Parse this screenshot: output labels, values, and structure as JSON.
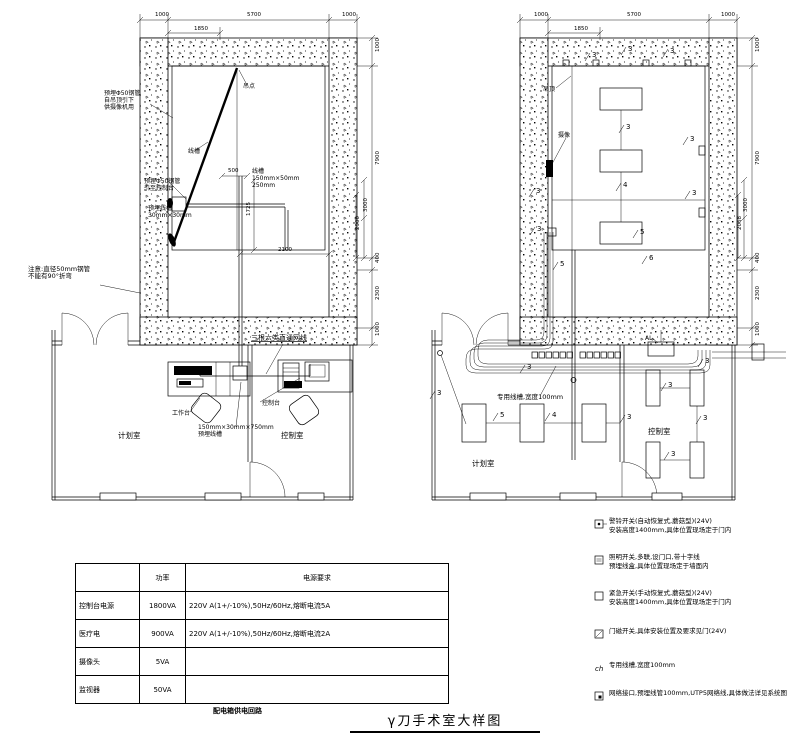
{
  "title": "γ刀手术室大样图",
  "table": {
    "caption": "配电箱供电回路",
    "headers": [
      "",
      "功率",
      "电源要求"
    ],
    "rows": [
      [
        "控制台电源",
        "1800VA",
        "220V A(1+/-10%),50Hz/60Hz,熔断电流5A"
      ],
      [
        "医疗电",
        "900VA",
        "220V A(1+/-10%),50Hz/60Hz,熔断电流2A"
      ],
      [
        "摄像头",
        "5VA",
        ""
      ],
      [
        "监视器",
        "50VA",
        ""
      ]
    ]
  },
  "legend": {
    "items": [
      {
        "name": "bell-switch",
        "lines": [
          "警铃开关(自动恢复式,蘑菇型)(24V)",
          "安装高度1400mm,具体位置现场定于门内"
        ]
      },
      {
        "name": "lighting-switch",
        "lines": [
          "照明开关,多联,设门口,带十字线",
          "预埋线盒,具体位置现场定于墙面内"
        ]
      },
      {
        "name": "emergency-switch",
        "lines": [
          "紧急开关(手动恢复式,蘑菇型)(24V)",
          "安装高度1400mm,具体位置现场定于门内"
        ]
      },
      {
        "name": "door-magnetic-switch",
        "lines": [
          "门磁开关,具体安装位置及要求见门(24V)"
        ]
      },
      {
        "name": "cable-tray",
        "symbol_text": "ch",
        "lines": [
          "专用线槽,宽度100mm"
        ]
      },
      {
        "name": "network-outlet",
        "lines": [
          "网络接口,预埋线管100mm,UTP5网络线,具体做法详见系统图"
        ]
      }
    ]
  },
  "annotations": {
    "dims": [
      {
        "t": "1000",
        "x": 155,
        "y": 16
      },
      {
        "t": "5700",
        "x": 247,
        "y": 16
      },
      {
        "t": "1000",
        "x": 342,
        "y": 16
      },
      {
        "t": "1850",
        "x": 194,
        "y": 30
      },
      {
        "t": "1000",
        "x": 534,
        "y": 16
      },
      {
        "t": "5700",
        "x": 627,
        "y": 16
      },
      {
        "t": "1000",
        "x": 721,
        "y": 16
      },
      {
        "t": "1850",
        "x": 574,
        "y": 30
      },
      {
        "t": "1000",
        "x": 379,
        "y": 52,
        "rot": true
      },
      {
        "t": "7900",
        "x": 379,
        "y": 165,
        "rot": true
      },
      {
        "t": "3000",
        "x": 367,
        "y": 212,
        "rot": true
      },
      {
        "t": "2900",
        "x": 359,
        "y": 230,
        "rot": true
      },
      {
        "t": "400",
        "x": 379,
        "y": 263,
        "rot": true
      },
      {
        "t": "2300",
        "x": 379,
        "y": 300,
        "rot": true
      },
      {
        "t": "1000",
        "x": 379,
        "y": 336,
        "rot": true
      },
      {
        "t": "1000",
        "x": 759,
        "y": 52,
        "rot": true
      },
      {
        "t": "7900",
        "x": 759,
        "y": 165,
        "rot": true
      },
      {
        "t": "3000",
        "x": 747,
        "y": 212,
        "rot": true
      },
      {
        "t": "2068",
        "x": 741,
        "y": 230,
        "rot": true
      },
      {
        "t": "400",
        "x": 759,
        "y": 263,
        "rot": true
      },
      {
        "t": "2300",
        "x": 759,
        "y": 300,
        "rot": true
      },
      {
        "t": "1000",
        "x": 759,
        "y": 336,
        "rot": true
      },
      {
        "t": "500",
        "x": 228,
        "y": 172
      },
      {
        "t": "1725",
        "x": 250,
        "y": 216,
        "rot": true
      },
      {
        "t": "2100",
        "x": 278,
        "y": 251
      }
    ],
    "circuits": [
      {
        "t": "3",
        "x": 592,
        "y": 57
      },
      {
        "t": "3",
        "x": 628,
        "y": 51
      },
      {
        "t": "3",
        "x": 670,
        "y": 53
      },
      {
        "t": "3",
        "x": 690,
        "y": 141
      },
      {
        "t": "3",
        "x": 536,
        "y": 193
      },
      {
        "t": "3",
        "x": 692,
        "y": 195
      },
      {
        "t": "3",
        "x": 626,
        "y": 129
      },
      {
        "t": "4",
        "x": 623,
        "y": 187
      },
      {
        "t": "3",
        "x": 537,
        "y": 231
      },
      {
        "t": "5",
        "x": 640,
        "y": 234
      },
      {
        "t": "6",
        "x": 649,
        "y": 260
      },
      {
        "t": "5",
        "x": 560,
        "y": 266
      },
      {
        "t": "3",
        "x": 437,
        "y": 395
      },
      {
        "t": "5",
        "x": 500,
        "y": 417
      },
      {
        "t": "4",
        "x": 552,
        "y": 417
      },
      {
        "t": "3",
        "x": 627,
        "y": 419
      },
      {
        "t": "3",
        "x": 668,
        "y": 387
      },
      {
        "t": "3",
        "x": 705,
        "y": 363
      },
      {
        "t": "3",
        "x": 671,
        "y": 456
      },
      {
        "t": "3",
        "x": 703,
        "y": 420
      },
      {
        "t": "3",
        "x": 527,
        "y": 369
      }
    ],
    "notes": [
      {
        "x": 104,
        "y": 95,
        "lines": [
          "预埋Φ50钢管",
          "自吊顶引下",
          "供摄像机用"
        ],
        "name": "note-conduit-camera"
      },
      {
        "x": 243,
        "y": 88,
        "lines": [
          "吊点"
        ],
        "name": "label-hanging-point"
      },
      {
        "x": 188,
        "y": 153,
        "lines": [
          "线槽"
        ],
        "name": "label-cable-tray"
      },
      {
        "x": 144,
        "y": 183,
        "lines": [
          "预埋Φ50钢管",
          "引至控制台"
        ],
        "name": "note-conduit-console"
      },
      {
        "x": 148,
        "y": 210,
        "lines": [
          "预埋线槽",
          "30mm×30mm"
        ],
        "name": "note-embedded-tray"
      },
      {
        "x": 252,
        "y": 173,
        "lines": [
          "线槽",
          "150mm×50mm",
          "250mm"
        ],
        "name": "note-tray-size"
      },
      {
        "x": 28,
        "y": 271,
        "size": 6.5,
        "lines": [
          "注意:直径50mm钢管",
          "不能有90°折弯"
        ],
        "name": "note-pipe-warning"
      },
      {
        "x": 251,
        "y": 340,
        "size": 7,
        "underline": true,
        "lines": [
          "三根六类直通网线"
        ],
        "name": "note-network-cables"
      },
      {
        "x": 172,
        "y": 415,
        "lines": [
          "工作台"
        ],
        "name": "label-workbench"
      },
      {
        "x": 198,
        "y": 429,
        "lines": [
          "150mm×30mm×750mm",
          "预埋线槽"
        ],
        "name": "note-floor-tray"
      },
      {
        "x": 262,
        "y": 405,
        "lines": [
          "控制台"
        ],
        "name": "label-console"
      },
      {
        "x": 118,
        "y": 438,
        "size": 7.5,
        "lines": [
          "计划室"
        ],
        "name": "room-label-planning"
      },
      {
        "x": 281,
        "y": 438,
        "size": 7.5,
        "lines": [
          "控制室"
        ],
        "name": "room-label-control"
      },
      {
        "x": 543,
        "y": 91,
        "lines": [
          "吊顶"
        ],
        "name": "label-ceiling"
      },
      {
        "x": 558,
        "y": 137,
        "lines": [
          "摄像"
        ],
        "name": "label-camera"
      },
      {
        "x": 497,
        "y": 399,
        "size": 6.5,
        "lines": [
          "专用线槽,宽度100mm"
        ],
        "name": "note-tray-width"
      },
      {
        "x": 472,
        "y": 466,
        "size": 7.5,
        "lines": [
          "计划室"
        ],
        "name": "room-label-planning-2"
      },
      {
        "x": 648,
        "y": 434,
        "size": 7.5,
        "lines": [
          "控制室"
        ],
        "name": "room-label-control-2"
      },
      {
        "x": 645,
        "y": 340,
        "size": 6,
        "lines": [
          "AL"
        ],
        "name": "label-al-box"
      }
    ]
  }
}
